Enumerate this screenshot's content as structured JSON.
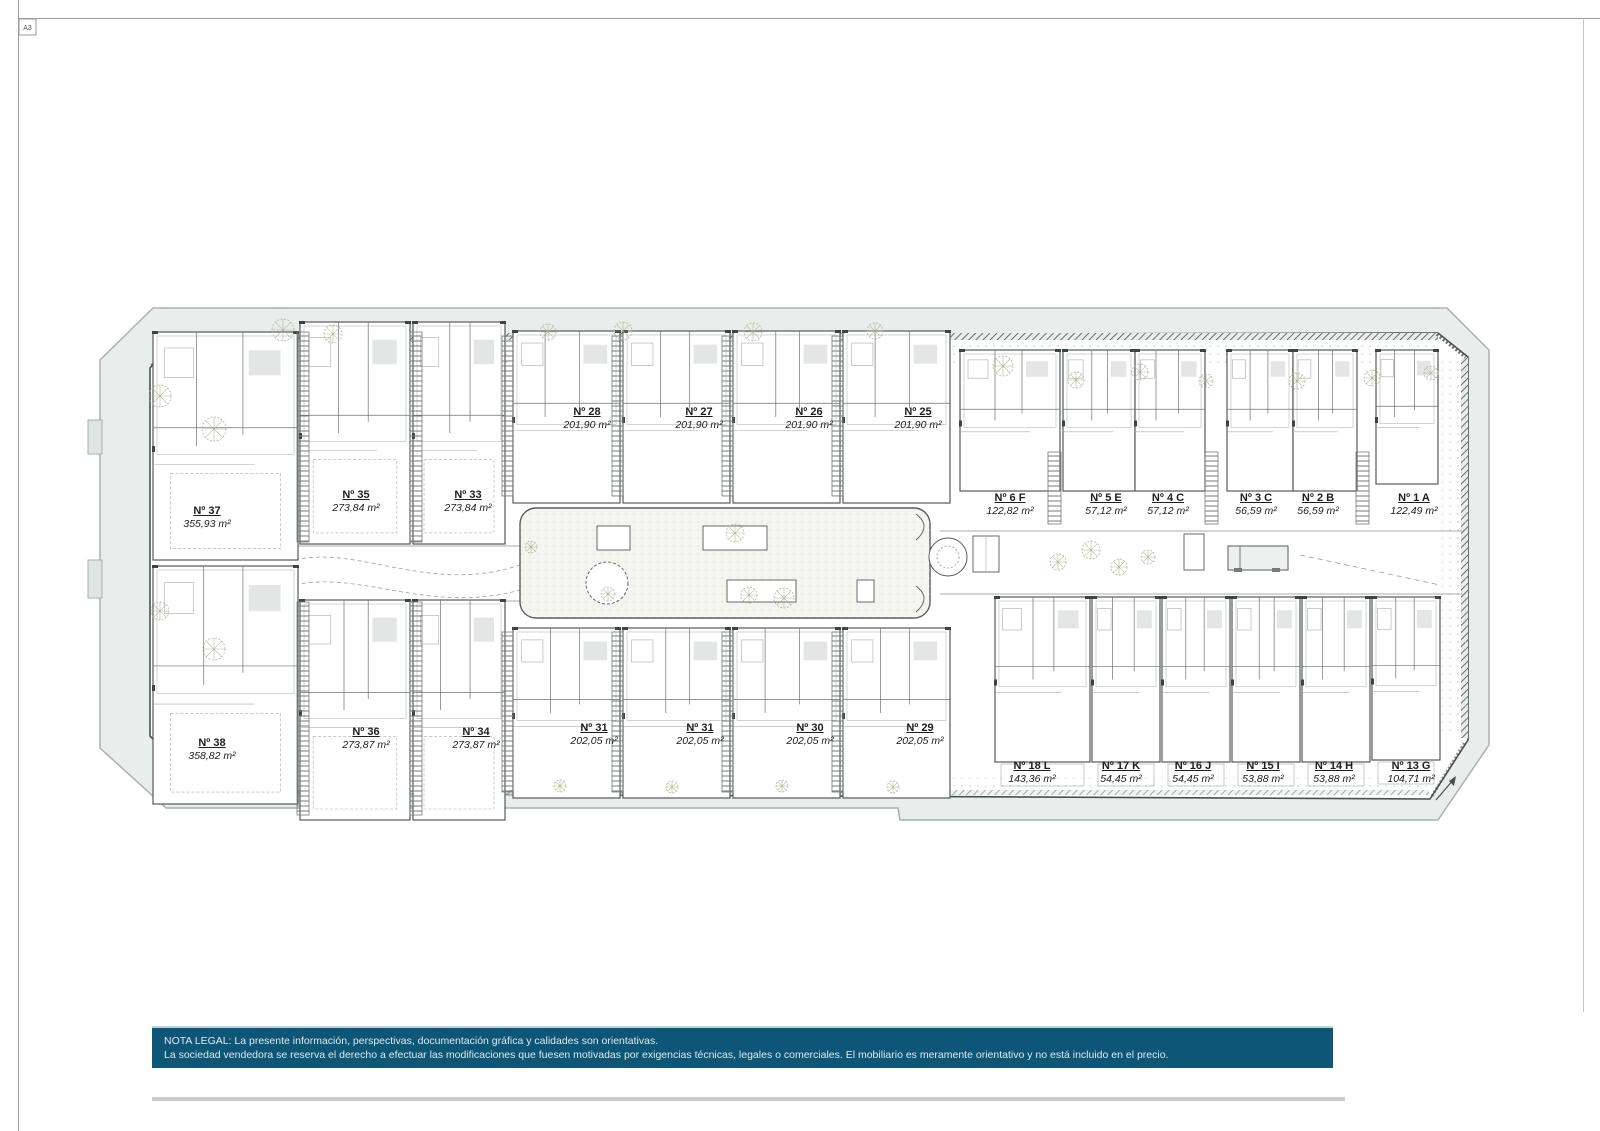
{
  "sheet": {
    "format_label": "A3"
  },
  "plan": {
    "units": [
      {
        "number": "Nº 37",
        "area": "355,93 m²",
        "x": 207,
        "y": 505
      },
      {
        "number": "Nº 35",
        "area": "273,84 m²",
        "x": 356,
        "y": 489
      },
      {
        "number": "Nº 33",
        "area": "273,84 m²",
        "x": 468,
        "y": 489
      },
      {
        "number": "Nº 28",
        "area": "201,90 m²",
        "x": 587,
        "y": 406
      },
      {
        "number": "Nº 27",
        "area": "201,90 m²",
        "x": 699,
        "y": 406
      },
      {
        "number": "Nº 26",
        "area": "201,90 m²",
        "x": 809,
        "y": 406
      },
      {
        "number": "Nº 25",
        "area": "201,90 m²",
        "x": 918,
        "y": 406
      },
      {
        "number": "Nº 6 F",
        "area": "122,82 m²",
        "x": 1010,
        "y": 492
      },
      {
        "number": "Nº 5 E",
        "area": "57,12 m²",
        "x": 1106,
        "y": 492
      },
      {
        "number": "Nº 4 C",
        "area": "57,12 m²",
        "x": 1168,
        "y": 492
      },
      {
        "number": "Nº 3 C",
        "area": "56,59 m²",
        "x": 1256,
        "y": 492
      },
      {
        "number": "Nº 2 B",
        "area": "56,59 m²",
        "x": 1318,
        "y": 492
      },
      {
        "number": "Nº 1 A",
        "area": "122,49 m²",
        "x": 1414,
        "y": 492
      },
      {
        "number": "Nº 38",
        "area": "358,82 m²",
        "x": 212,
        "y": 737
      },
      {
        "number": "Nº 36",
        "area": "273,87 m²",
        "x": 366,
        "y": 726
      },
      {
        "number": "Nº 34",
        "area": "273,87 m²",
        "x": 476,
        "y": 726
      },
      {
        "number": "Nº 31",
        "area": "202,05 m²",
        "x": 594,
        "y": 722
      },
      {
        "number": "Nº 31",
        "area": "202,05 m²",
        "x": 700,
        "y": 722
      },
      {
        "number": "Nº 30",
        "area": "202,05 m²",
        "x": 810,
        "y": 722
      },
      {
        "number": "Nº 29",
        "area": "202,05 m²",
        "x": 920,
        "y": 722
      },
      {
        "number": "Nº 18 L",
        "area": "143,36 m²",
        "x": 1032,
        "y": 760
      },
      {
        "number": "Nº 17 K",
        "area": "54,45 m²",
        "x": 1121,
        "y": 760
      },
      {
        "number": "Nº 16 J",
        "area": "54,45 m²",
        "x": 1193,
        "y": 760
      },
      {
        "number": "Nº 15 I",
        "area": "53,88 m²",
        "x": 1263,
        "y": 760
      },
      {
        "number": "Nº 14 H",
        "area": "53,88 m²",
        "x": 1334,
        "y": 760
      },
      {
        "number": "Nº 13 G",
        "area": "104,71 m²",
        "x": 1411,
        "y": 760
      }
    ]
  },
  "legal": {
    "line1": "NOTA LEGAL: La presente información, perspectivas, documentación gráfica y calidades son orientativas.",
    "line2": "La sociedad vendedora se reserva el derecho a efectuar las modificaciones que fuesen motivadas por exigencias técnicas, legales o comerciales. El mobiliario es meramente orientativo y no está incluido en el precio."
  },
  "colors": {
    "banner_bg": "#0e5677",
    "banner_text": "#dde9ee",
    "site_fill": "#e9edeb",
    "wall_line": "#565b5a",
    "tree_line": "#a9af93"
  }
}
